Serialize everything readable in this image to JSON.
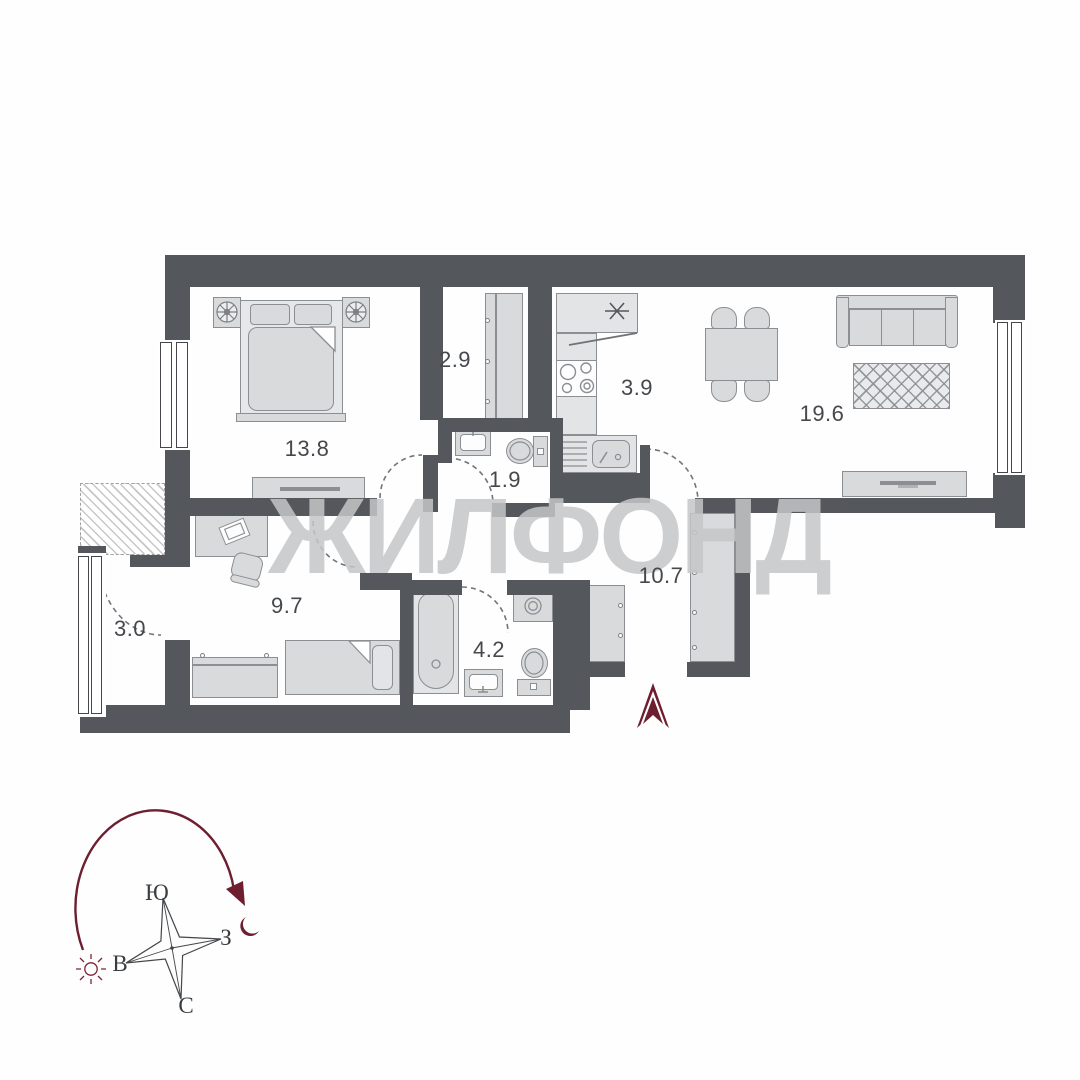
{
  "plan": {
    "watermark": "ЖИЛФОНД",
    "rooms": [
      {
        "name": "bedroom",
        "area": "13.8"
      },
      {
        "name": "wardrobe",
        "area": "2.9"
      },
      {
        "name": "kitchen",
        "area": "3.9"
      },
      {
        "name": "living-room",
        "area": "19.6"
      },
      {
        "name": "toilet",
        "area": "1.9"
      },
      {
        "name": "hallway",
        "area": "10.7"
      },
      {
        "name": "kids-room",
        "area": "9.7"
      },
      {
        "name": "balcony",
        "area": "3.0"
      },
      {
        "name": "bathroom",
        "area": "4.2"
      }
    ]
  },
  "compass": {
    "south": "Ю",
    "west": "З",
    "east": "В",
    "north": "С"
  },
  "colors": {
    "wall": "#54575b",
    "furniture_fill": "#d9dadc",
    "furniture_stroke": "#8b8e92",
    "accent": "#6d1f2f",
    "watermark": "#c7c8ca",
    "label_text": "#45484c"
  }
}
